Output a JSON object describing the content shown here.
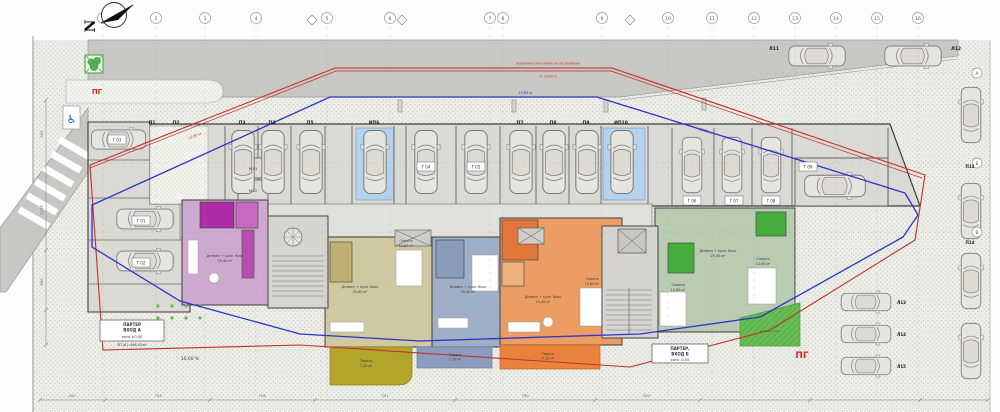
{
  "title": "Ситуационен план — партер",
  "north": {
    "letter": "N"
  },
  "grid": {
    "top": [
      "1",
      "2",
      "3",
      "4",
      "5",
      "6",
      "7",
      "8",
      "9",
      "10",
      "11",
      "12",
      "13",
      "14",
      "15",
      "16"
    ],
    "right": [
      "А",
      "Б",
      "В"
    ]
  },
  "regulation": {
    "restriction_label_1": "ограничителна линия на застрояване",
    "restriction_label_2": "Н: 15,00 м",
    "offset_red": "13,80 м",
    "offset_blue": "13,85 м"
  },
  "areas": {
    "pg_left": "ПГ",
    "pg_right": "ПГ",
    "slope": "10,00 %",
    "lawn": "зелена площ"
  },
  "entrance_a": {
    "l1": "ПАРТЕР",
    "l2": "ВХОД А",
    "l3": "кота ±0,00",
    "l4": "ЗП (А): 446,03 м²"
  },
  "entrance_b": {
    "l1": "ПАРТЕР,",
    "l2": "ВХОД Б",
    "l3": "кота -0,05"
  },
  "garages": [
    "Г 01",
    "Г 02",
    "Г 03",
    "Г 04",
    "Г 05",
    "Г 06",
    "Г 07",
    "Г 08",
    "Г 09"
  ],
  "parking": [
    "П1",
    "П2",
    "П3",
    "П4",
    "П5",
    "ИП6",
    "П7",
    "П8",
    "П9",
    "ИП10"
  ],
  "street_parking": [
    "Л11",
    "Л12",
    "Л13",
    "Л14",
    "Л15",
    "П13",
    "П14"
  ],
  "storage": [
    "М 01",
    "М 02"
  ],
  "rooms": {
    "living": "Дневен + кухн. бокс",
    "bedroom": "Спалня",
    "terrace": "Тераса",
    "living_area": "25,40 м²",
    "bedroom_area": "12,60 м²",
    "terrace_area": "7,10 м²"
  },
  "dims": {
    "bottom": [
      "400",
      "753",
      "756",
      "791",
      "790",
      "825"
    ],
    "left": [
      "500",
      "1275",
      "690"
    ]
  },
  "colors": {
    "regulation_blue": "#2a35c8",
    "restriction_red": "#c03030",
    "building_gray": "#dbd9d3",
    "apartment_purple": "#cda8cf",
    "apartment_tan": "#cfc8a0",
    "apartment_blue": "#9fb0c6",
    "apartment_orange": "#eb9d63",
    "apartment_green": "#b9cbb0",
    "terrace_olive": "#b2a52c",
    "terrace_orange": "#e8823c",
    "lawn_green": "#67bd52",
    "parking_blue": "#b4d2ec"
  }
}
